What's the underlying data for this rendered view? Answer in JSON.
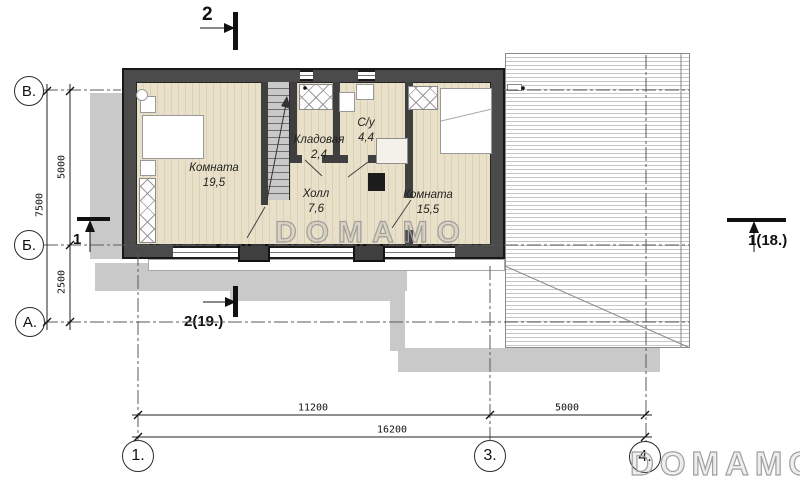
{
  "watermark": {
    "text": "DOMAMO"
  },
  "rooms": [
    {
      "name": "Комната",
      "area": "19,5"
    },
    {
      "name": "Холл",
      "area": "7,6"
    },
    {
      "name": "Кладовая",
      "area": "2,4"
    },
    {
      "name": "С/у",
      "area": "4,4"
    },
    {
      "name": "Комната",
      "area": "15,5"
    }
  ],
  "axes": {
    "left": [
      "В.",
      "Б.",
      "А."
    ],
    "bottom": [
      "1.",
      "3.",
      "4."
    ]
  },
  "dimensions": {
    "vertical": {
      "upper": "5000",
      "lower": "2500",
      "total": "7500"
    },
    "horizontal": {
      "left": "11200",
      "right": "5000",
      "total": "16200"
    }
  },
  "sections": {
    "top": "2",
    "bottom": "2(19.)",
    "left": "1",
    "right": "1(18.)"
  },
  "palette": {
    "wall": "#4b4b4b",
    "floor": "#e9e0c9",
    "shadow": "#c9c9c9",
    "roof_line": "#c6c6c6"
  }
}
